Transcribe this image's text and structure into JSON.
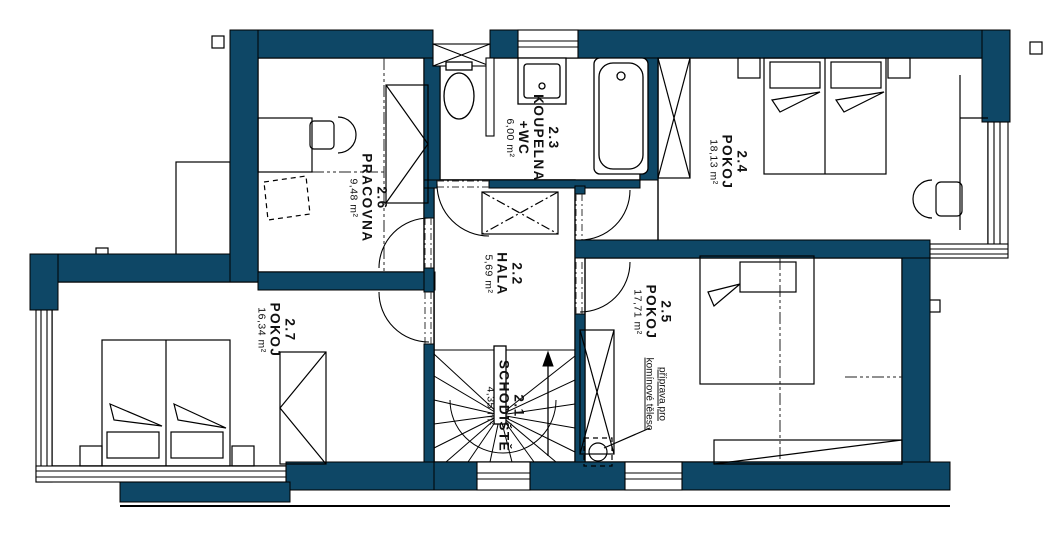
{
  "plan": {
    "type": "floor-plan",
    "floor_prefix": "2",
    "wall_color": "#0e4766",
    "line_color": "#0a0a0a"
  },
  "rooms": [
    {
      "id": "2.1",
      "name": "SCHODIŠTĚ",
      "area": "4,35 m²"
    },
    {
      "id": "2.2",
      "name": "HALA",
      "area": "5,69 m²"
    },
    {
      "id": "2.3",
      "name": "KOUPELNA",
      "name2": "+WC",
      "area": "6,00 m²"
    },
    {
      "id": "2.4",
      "name": "POKOJ",
      "area": "18,13 m²"
    },
    {
      "id": "2.5",
      "name": "POKOJ",
      "area": "17,71 m²"
    },
    {
      "id": "2.6",
      "name": "PRACOVNA",
      "area": "9,48 m²"
    },
    {
      "id": "2.7",
      "name": "POKOJ",
      "area": "16,34 m²"
    }
  ],
  "annotation": {
    "line1": "příprava pro",
    "line2": "komínové těleso"
  }
}
